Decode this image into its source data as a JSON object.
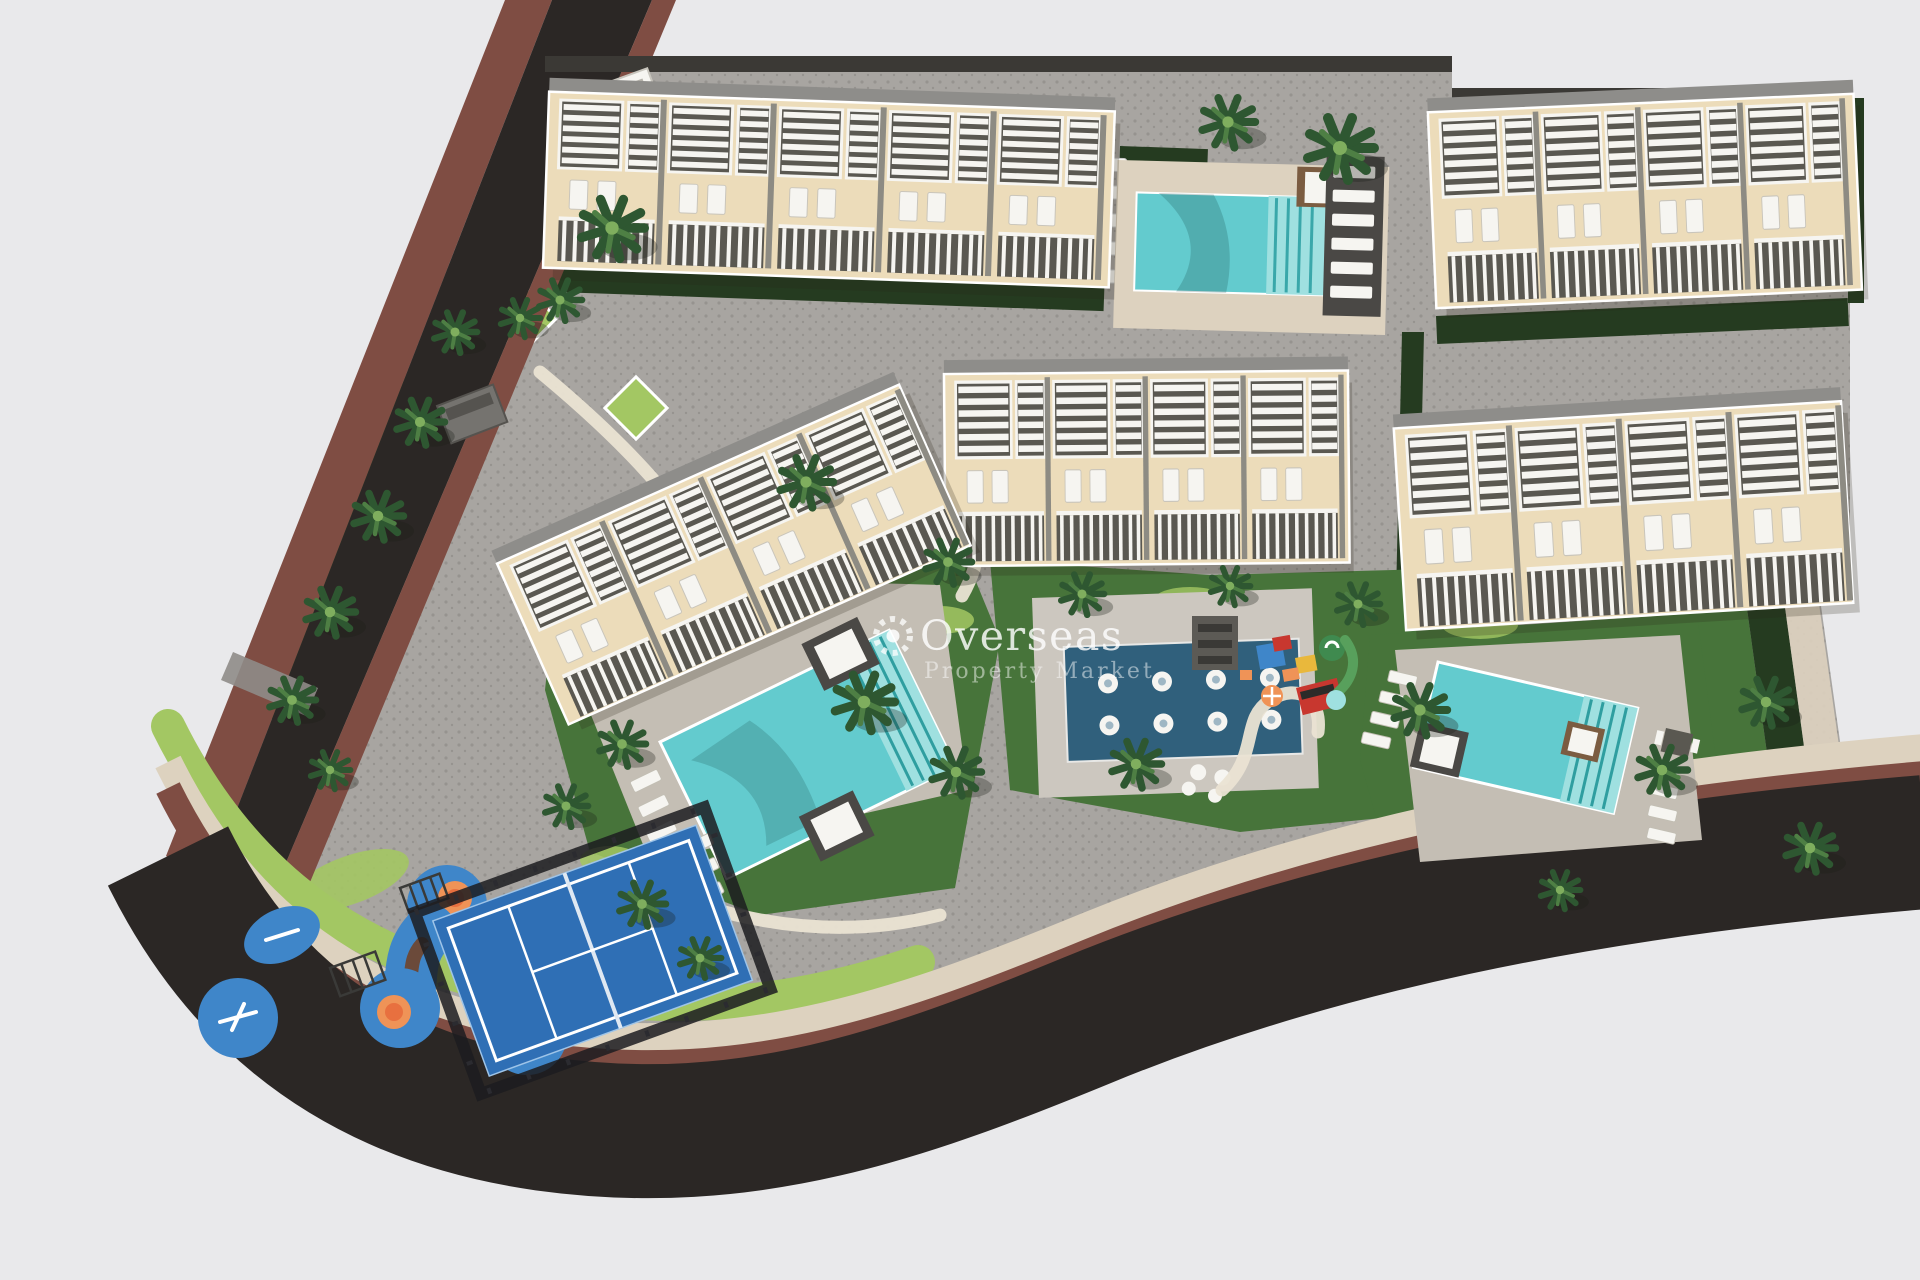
{
  "title": "Aerial 3D site plan render of a residential development with townhouse blocks, pools, playground and padel court",
  "watermark": {
    "brand": "Overseas",
    "tagline": "Property Market",
    "icon": "sun-icon"
  },
  "scene": {
    "building_blocks": 5,
    "swimming_pools": 3,
    "spa_jets": 8,
    "features": [
      "townhouse blocks with white pergolas",
      "communal swimming pools with daybed platforms",
      "spa jet water feature",
      "children playground",
      "splash pad",
      "padel court",
      "palm tree landscaping",
      "perimeter roads with brick edging"
    ]
  },
  "palette": {
    "background": "#e9e9eb",
    "pavement": "#a8a5a1",
    "pavement_dot": "#96938f",
    "asphalt": "#2b2725",
    "brick": "#7f4d43",
    "sidewalk": "#ddd2bf",
    "grass_light": "#a3c763",
    "lawn": "#47743a",
    "hedge": "#253b20",
    "palm": "#2e5731",
    "pool_water": "#63cbce",
    "pool_steps": "#9fe0e0",
    "spa_water": "#30607c",
    "spa_deck": "#ccc7bf",
    "pool_deck": "#c4beb4",
    "facade": "#ecdcba",
    "structure_white": "#f6f5f1",
    "structure_dark": "#5a5851",
    "roof_gray": "#8e8d8a",
    "deck_dark": "#4a4845",
    "daybed_brown": "#7b5c41",
    "court_blue": "#2f6fb5",
    "splash_blue": "#3f86c9",
    "play_orange": "#ef9357",
    "play_red": "#c8372f",
    "play_purple": "#6d4f9e",
    "play_yellow": "#e9b83c",
    "watermark_white": "#ffffff"
  }
}
